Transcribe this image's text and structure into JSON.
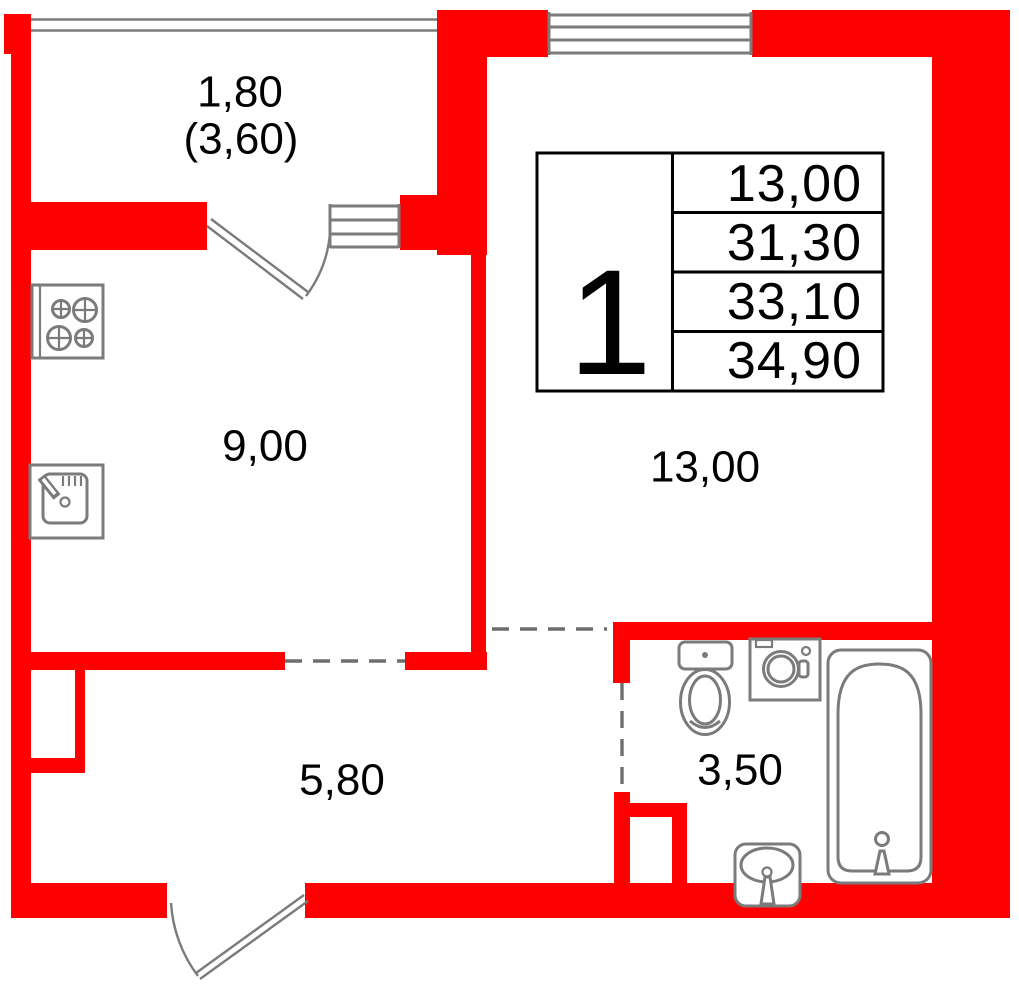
{
  "plan_title": "1-room apartment floor plan",
  "unit_card": {
    "unit_number": "1",
    "area_rows": [
      "13,00",
      "31,30",
      "33,10",
      "34,90"
    ]
  },
  "room_labels": {
    "balcony_area": "1,80",
    "balcony_area_reduced": "(3,60)",
    "kitchen_area": "9,00",
    "living_room_area": "13,00",
    "hallway_area": "5,80",
    "bathroom_area": "3,50"
  },
  "colors": {
    "wall_red": "#ff0000",
    "fixture_gray": "#7b7b7b",
    "line_black": "#000000"
  }
}
